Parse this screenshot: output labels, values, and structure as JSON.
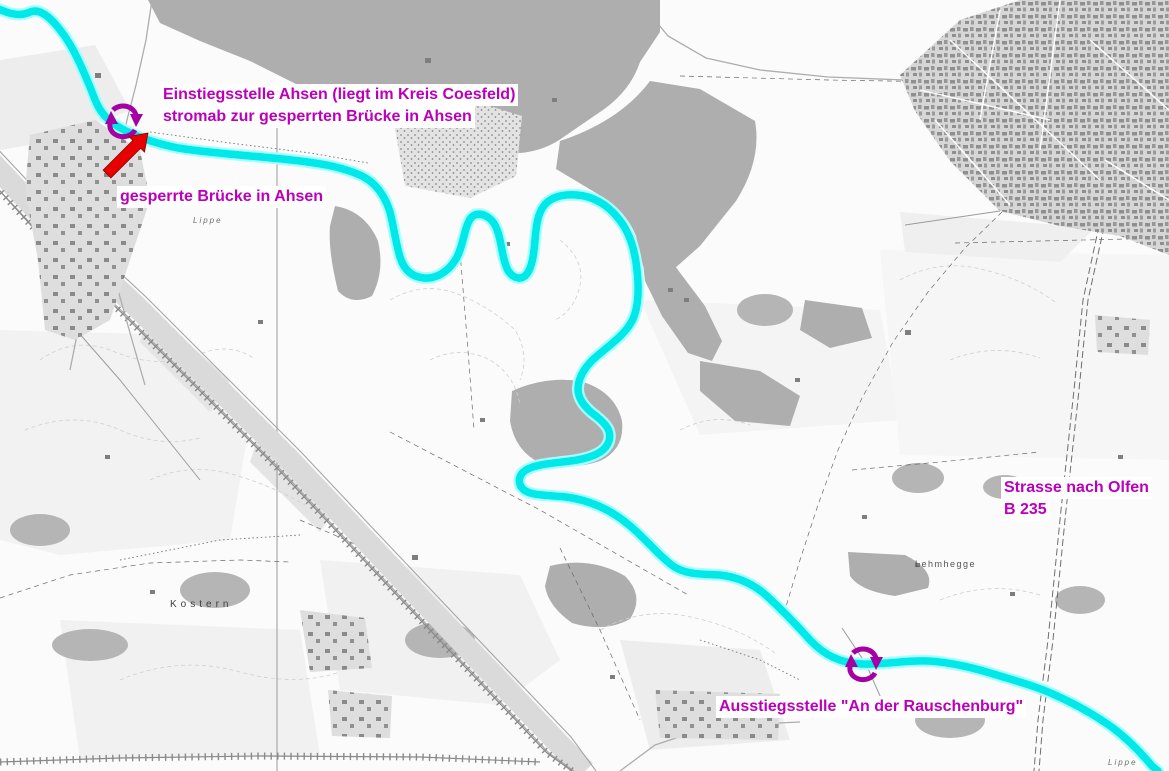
{
  "annotations": {
    "einstieg_line1": "Einstiegsstelle Ahsen (liegt im Kreis Coesfeld)",
    "einstieg_line2": "stromab zur gesperrten Brücke in Ahsen",
    "gesperrte_bruecke": "gesperrte Brücke in Ahsen",
    "strasse_line1": "Strasse nach Olfen",
    "strasse_line2": "B 235",
    "ausstieg": "Ausstiegsstelle \"An der Rauschenburg\""
  },
  "place_labels": {
    "lehmhegge": "Lehmhegge",
    "kostern": "Kostern",
    "lippe_west": "Lippe",
    "lippe_southeast": "Lippe"
  },
  "markers": {
    "einstieg_marker": "loop-arrows",
    "ausstieg_marker": "loop-arrows",
    "bridge_pointer": "red-arrow-northeast"
  },
  "colors": {
    "annotation_text": "#BB00BB",
    "marker_purple": "#A400A4",
    "arrow_red": "#E60000",
    "river_highlight": "#00E8E8",
    "river_halo": "#A8FFFF",
    "forest": "#AEAEAE",
    "town": "#D6D6D6",
    "background": "#FBFBFB"
  }
}
